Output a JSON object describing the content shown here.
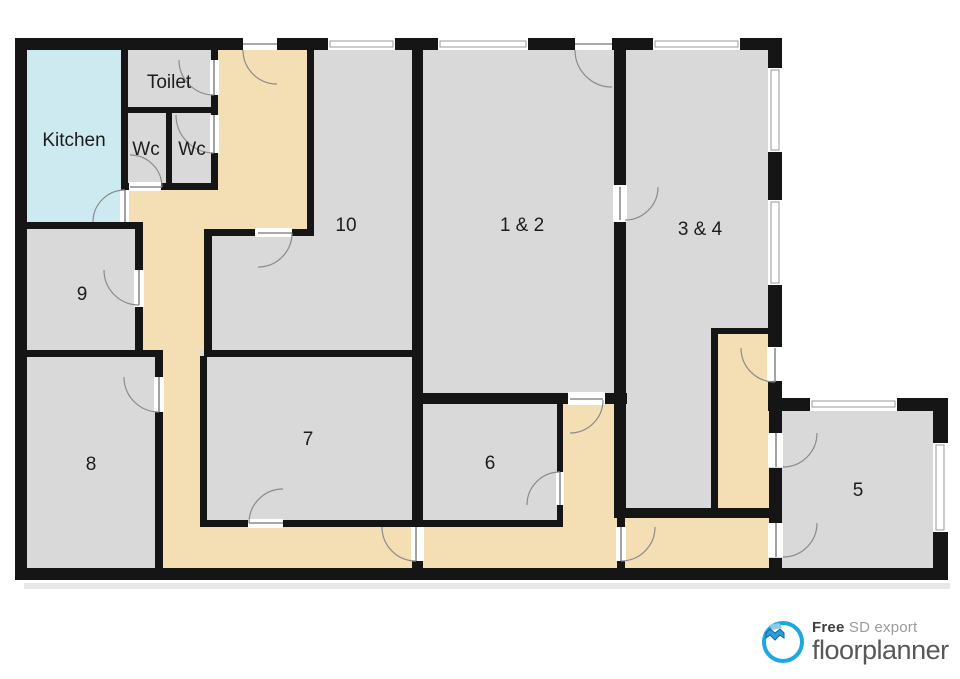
{
  "colors": {
    "wall": "#151515",
    "room": "#d9d9d9",
    "hall": "#f4deb4",
    "kitchen": "#cdeaf1",
    "door_line": "#8b8b8b",
    "window_line": "#9a9a9a",
    "label": "#1c1c1c",
    "ring": "#1ea7e0",
    "brand": "#58585a"
  },
  "rooms": [
    {
      "id": "kitchen",
      "label": "Kitchen"
    },
    {
      "id": "toilet",
      "label": "Toilet"
    },
    {
      "id": "wc-left",
      "label": "Wc"
    },
    {
      "id": "wc-right",
      "label": "Wc"
    },
    {
      "id": "room-10",
      "label": "10"
    },
    {
      "id": "room-1-2",
      "label": "1 & 2"
    },
    {
      "id": "room-3-4",
      "label": "3 & 4"
    },
    {
      "id": "room-9",
      "label": "9"
    },
    {
      "id": "room-8",
      "label": "8"
    },
    {
      "id": "room-7",
      "label": "7"
    },
    {
      "id": "room-6",
      "label": "6"
    },
    {
      "id": "room-5",
      "label": "5"
    }
  ],
  "footer": {
    "free": "Free",
    "tagline": "SD export",
    "brand": "floorplanner"
  }
}
